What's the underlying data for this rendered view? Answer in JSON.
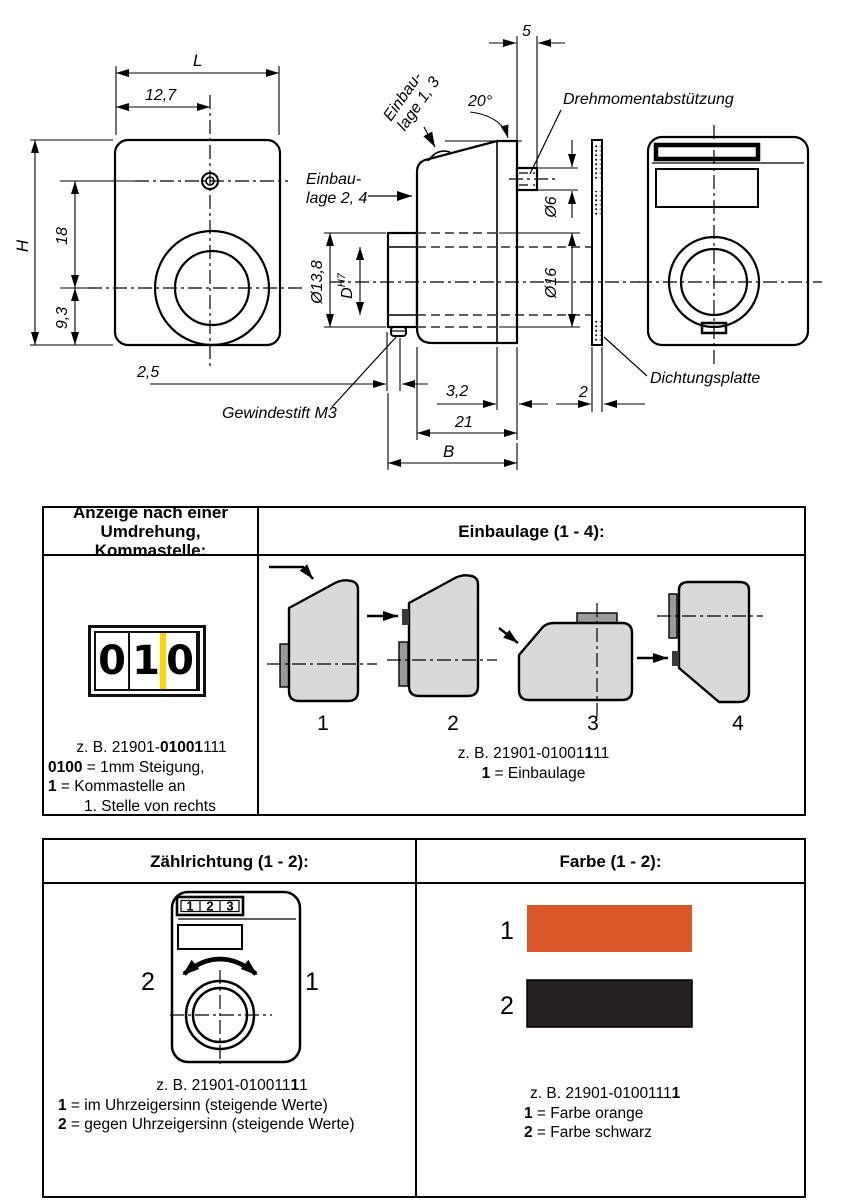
{
  "drawing": {
    "front": {
      "L": "L",
      "w1": "12,7",
      "H": "H",
      "h1": "18",
      "h2": "9,3"
    },
    "side": {
      "top_width": "5",
      "angle": "20°",
      "pin_dia": "Ø6",
      "collar_dia": "Ø13,8",
      "bore_letter": "D",
      "bore_tol": "H7",
      "hub_dia": "Ø16",
      "screw_offset": "2,5",
      "plate_thk": "3,2",
      "gasket_thk": "2",
      "depth1": "21",
      "depth2": "B",
      "label_pos13_l1": "Einbau-",
      "label_pos13_l2": "lage 1, 3",
      "label_pos24_l1": "Einbau-",
      "label_pos24_l2": "lage 2, 4",
      "label_torque": "Drehmomentabstützung",
      "label_gasket": "Dichtungsplatte",
      "label_setscrew": "Gewindestift M3"
    }
  },
  "table1": {
    "header_left_l1": "Anzeige nach einer",
    "header_left_l2": "Umdrehung, Kommastelle:",
    "header_right": "Einbaulage (1 - 4):",
    "counter": {
      "d1": "0",
      "d2": "1",
      "d3": "0"
    },
    "figures": [
      "1",
      "2",
      "3",
      "4"
    ],
    "caption_left": {
      "l1_pre": "z. B. 21901-",
      "l1_bold": "01001",
      "l1_post": "111",
      "l2_bold": "0100",
      "l2_rest": " = 1mm Steigung,",
      "l3_bold": "1",
      "l3_rest": " = Kommastelle an",
      "l4": "1. Stelle von rechts"
    },
    "caption_right": {
      "l1_pre": "z. B. 21901-01001",
      "l1_bold": "1",
      "l1_post": "11",
      "l2_bold": "1",
      "l2_rest": " = Einbaulage"
    }
  },
  "table2": {
    "header_left": "Zählrichtung (1 - 2):",
    "header_right": "Farbe (1 - 2):",
    "device_digits": {
      "d1": "1",
      "d2": "2",
      "d3": "3"
    },
    "dir_ccw": "2",
    "dir_cw": "1",
    "caption_left": {
      "l1_pre": "z. B.  21901-010011",
      "l1_bold": "1",
      "l1_post": "1",
      "l2_bold": "1",
      "l2_rest": " = im Uhrzeigersinn (steigende Werte)",
      "l3_bold": "2",
      "l3_rest": " = gegen Uhrzeigersinn (steigende Werte)"
    },
    "swatches": [
      {
        "num": "1",
        "color": "#d9572b"
      },
      {
        "num": "2",
        "color": "#262223"
      }
    ],
    "caption_right": {
      "l1_pre": "z. B.  21901-0100111",
      "l1_bold": "1",
      "l1_post": "",
      "l2_bold": "1",
      "l2_rest": " = Farbe orange",
      "l3_bold": "2",
      "l3_rest": " = Farbe schwarz"
    }
  },
  "colors": {
    "line": "#000000",
    "orange": "#d9572b",
    "swatch_black": "#262223",
    "fig_fill": "#d9d9d9",
    "tab_fill": "#9a9a9a",
    "nub_fill": "#3a3a3a",
    "marker_yellow": "#ffd500"
  }
}
